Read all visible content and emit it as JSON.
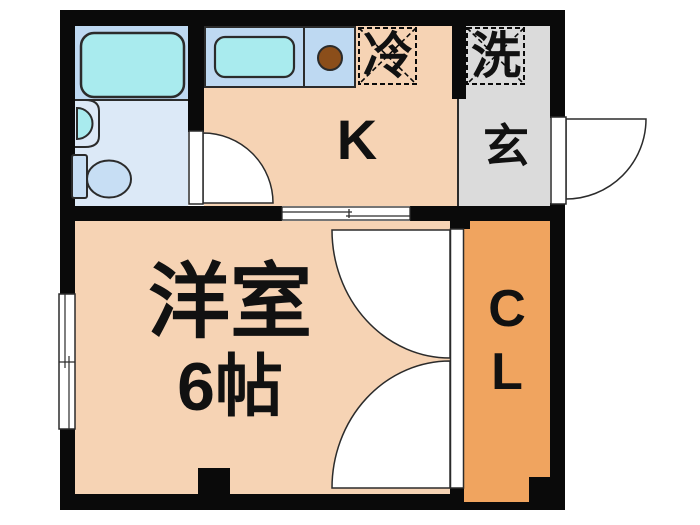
{
  "title": "1K apartment floor plan",
  "colors": {
    "wall": "#0a0a0a",
    "line": "#2b2b2b",
    "floor-room": "#f6d3b4",
    "floor-closet": "#f0a45f",
    "floor-entrance": "#dbdbdb",
    "bath-light": "#dce9f7",
    "bath-mid": "#bed9f2",
    "fixture-cyan": "#a9ebee",
    "toilet-fill": "#c7def4",
    "burner-brown": "#8b4e1a",
    "door-white": "#ffffff"
  },
  "rooms": {
    "western_room": {
      "name_label": "洋室",
      "size_label": "6帖"
    },
    "kitchen": {
      "label": "K"
    },
    "entrance": {
      "label": "玄"
    },
    "closet": {
      "label_top": "C",
      "label_bottom": "L"
    },
    "refrigerator": {
      "label": "冷"
    },
    "washer": {
      "label": "洗"
    }
  }
}
